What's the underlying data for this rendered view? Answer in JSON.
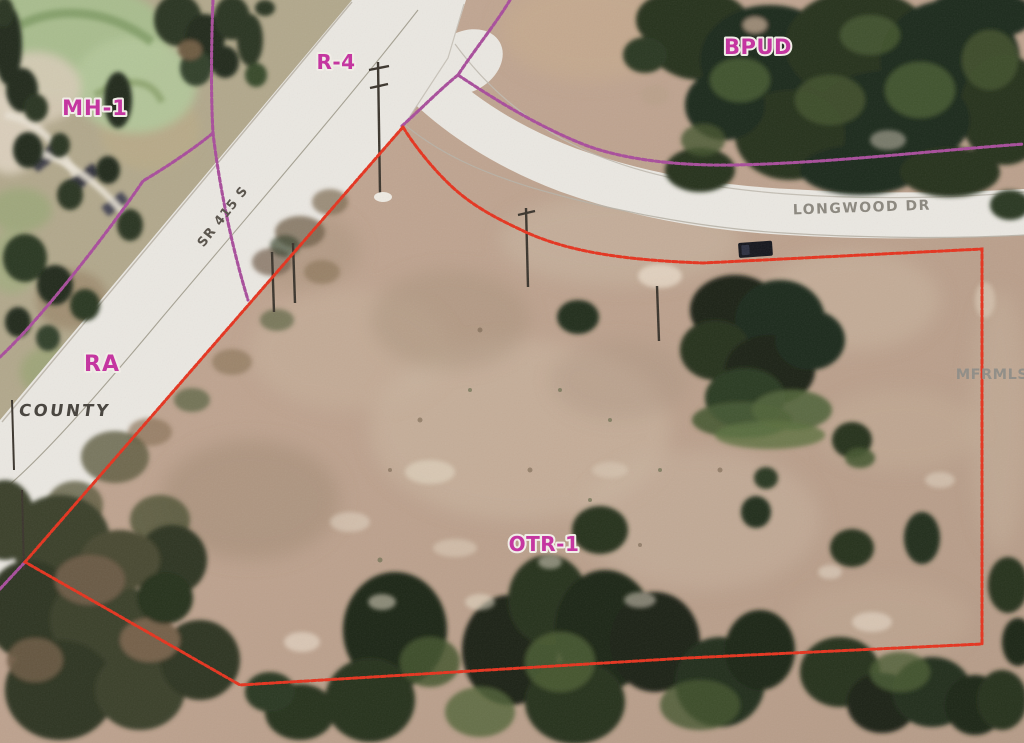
{
  "labels": {
    "mh1": "MH-1",
    "r4": "R-4",
    "bpud": "BPUD",
    "ra": "RA",
    "otr1": "OTR-1",
    "road_sr415": "SR 415 S",
    "road_longwood": "LONGWOOD DR",
    "county": "COUNTY",
    "watermark": "MFRMLS"
  },
  "colors": {
    "zoning_line": "#a84d9b",
    "zoning_label": "#c5309f",
    "parcel_outline": "#e5331e",
    "road_fill": "#ebe8e2",
    "dirt": "#bfa28d",
    "tree_dark": "#25301e",
    "tree_light": "#5d7040",
    "golf_green": "#a9bd8e",
    "road_label": "#8b877e",
    "county_label": "#45413b",
    "sr415_label": "#575149",
    "watermark": "#908d86"
  }
}
